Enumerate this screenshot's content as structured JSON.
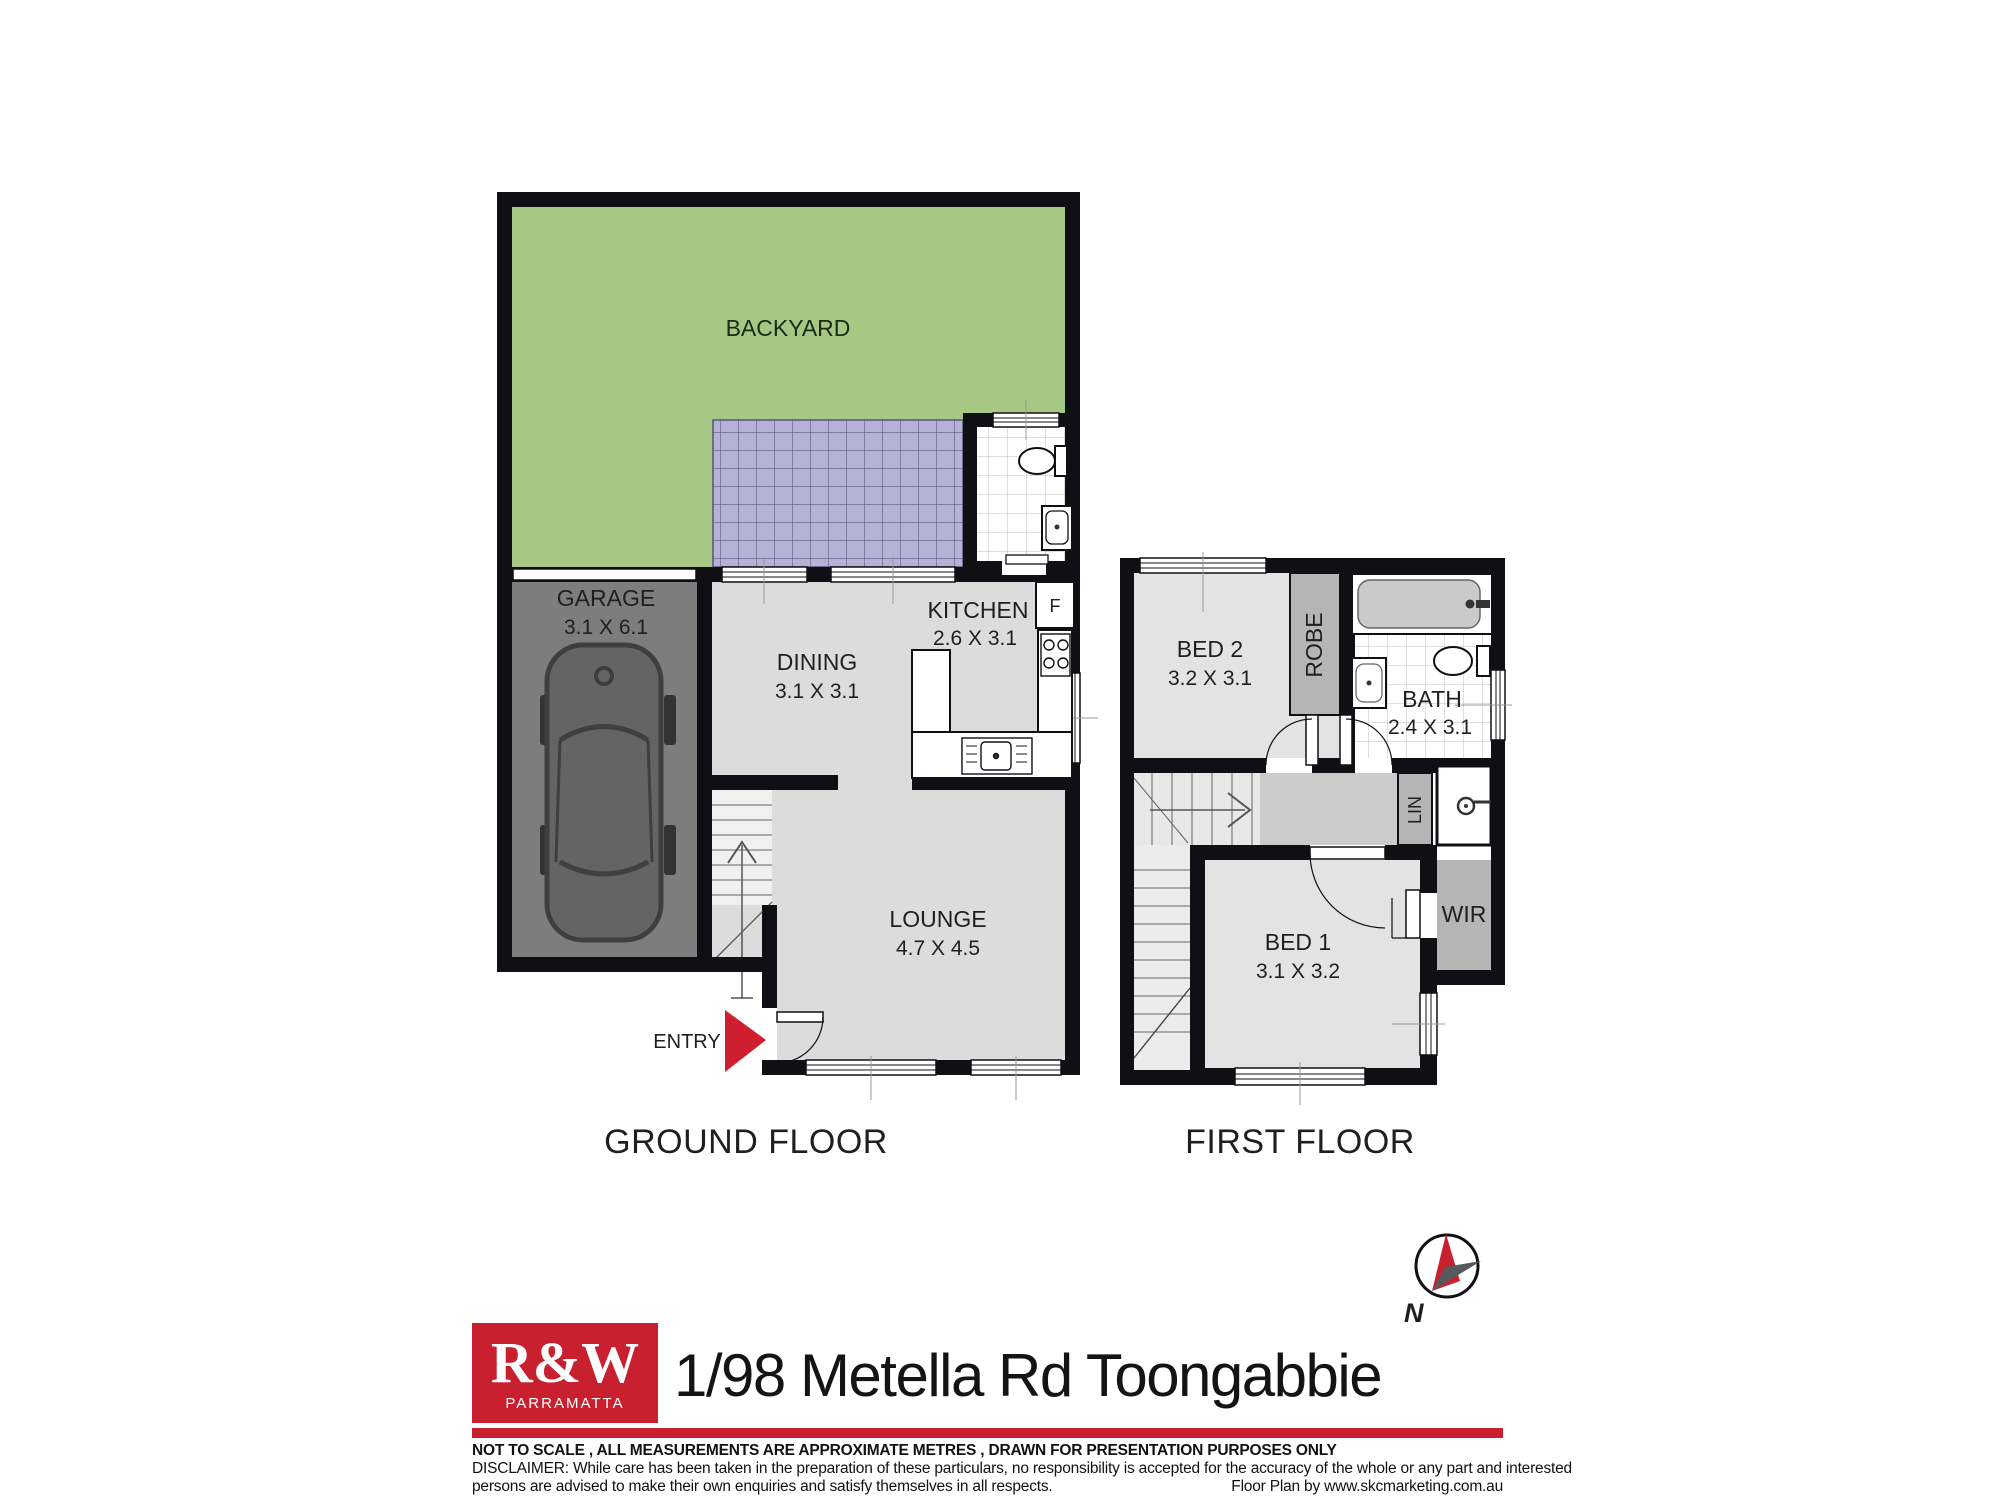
{
  "ground_floor": {
    "title": "GROUND FLOOR",
    "entry_label": "ENTRY",
    "fridge_label": "F",
    "rooms": {
      "backyard": {
        "label": "BACKYARD"
      },
      "garage": {
        "label": "GARAGE",
        "dimensions": "3.1 X 6.1"
      },
      "dining": {
        "label": "DINING",
        "dimensions": "3.1 X 3.1"
      },
      "kitchen": {
        "label": "KITCHEN",
        "dimensions": "2.6 X 3.1"
      },
      "lounge": {
        "label": "LOUNGE",
        "dimensions": "4.7 X 4.5"
      }
    }
  },
  "first_floor": {
    "title": "FIRST FLOOR",
    "rooms": {
      "bed2": {
        "label": "BED 2",
        "dimensions": "3.2 X 3.1"
      },
      "robe": {
        "label": "ROBE"
      },
      "bath": {
        "label": "BATH",
        "dimensions": "2.4 X 3.1"
      },
      "lin": {
        "label": "LIN"
      },
      "wir": {
        "label": "WIR"
      },
      "bed1": {
        "label": "BED 1",
        "dimensions": "3.1 X 3.2"
      }
    }
  },
  "compass": {
    "north_label": "N"
  },
  "footer": {
    "brand": "R&W",
    "branch": "PARRAMATTA",
    "address": "1/98 Metella Rd Toongabbie",
    "disclaimer_line1": "NOT TO SCALE , ALL MEASUREMENTS ARE APPROXIMATE METRES , DRAWN FOR PRESENTATION PURPOSES ONLY",
    "disclaimer_line2": "DISCLAIMER:  While care has been taken in the preparation of these particulars, no responsibility is accepted for the accuracy of the whole or any part and interested",
    "disclaimer_line3": "persons are advised to make their own enquiries and satisfy  themselves in all respects.",
    "credit": "Floor Plan by www.skcmarketing.com.au"
  },
  "colors": {
    "brand_red": "#c8202f",
    "backyard_green": "#a7c885",
    "paving_purple": "#b6b2d6",
    "garage_gray": "#7d7d7d",
    "wall_black": "#101014"
  }
}
